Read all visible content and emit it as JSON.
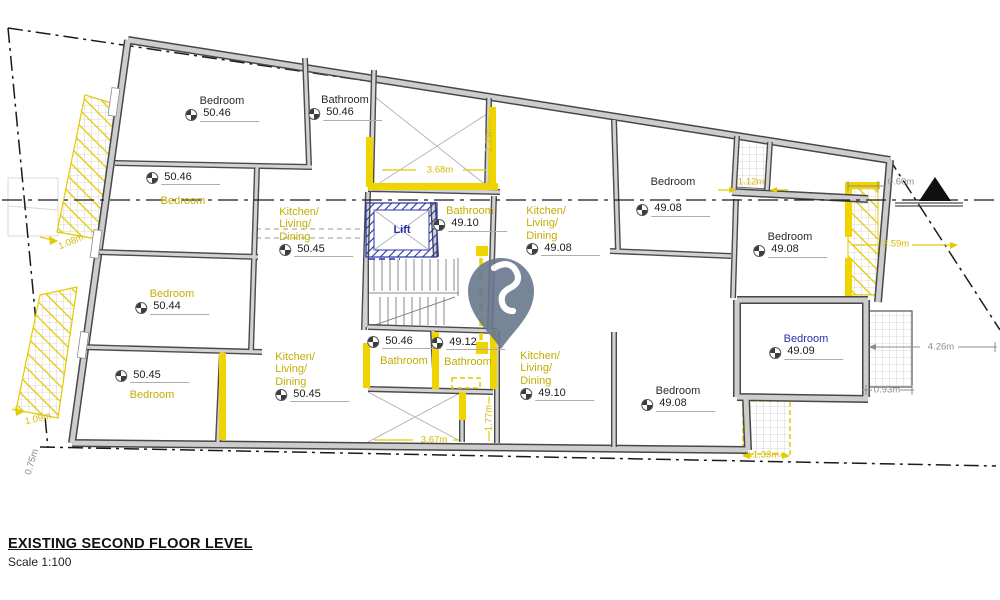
{
  "title": {
    "heading": "EXISTING SECOND FLOOR LEVEL",
    "scale": "Scale 1:100"
  },
  "colors": {
    "highlight": "#f0d400",
    "hatch_yellow": "#e4ca00",
    "label_yellow": "#c4ad00",
    "dim_yellow": "#d6b800",
    "blue": "#2733a8",
    "pin_gray_blue": "#68788c",
    "dim_gray": "#8c8c8c",
    "ink": "#1f1f1f"
  },
  "icons": {
    "pin": "location-pin",
    "north": "north-arrow",
    "spot_level": "quartered-circle-level-marker"
  },
  "rooms": [
    {
      "id": "bedroom-top-left",
      "lines": [
        "Bedroom"
      ],
      "color": "black",
      "value": "50.46",
      "order": "nf",
      "cx": 222,
      "y": 95
    },
    {
      "id": "bathroom-top-left",
      "lines": [
        "Bathroom"
      ],
      "color": "black",
      "value": "50.46",
      "order": "nf",
      "cx": 345,
      "y": 94
    },
    {
      "id": "bedroom-left-1",
      "lines": [
        "Bedroom"
      ],
      "color": "yellow",
      "value": "50.46",
      "order": "vf",
      "gap": 10,
      "cx": 183,
      "y": 171
    },
    {
      "id": "kitchen-living-dining-left-top",
      "lines": [
        "Kitchen/",
        "Living/",
        "Dining"
      ],
      "color": "yellow",
      "value": "50.45",
      "order": "nf",
      "cx": 316,
      "y": 206
    },
    {
      "id": "bedroom-left-2",
      "lines": [
        "Bedroom"
      ],
      "color": "yellow",
      "value": "50.44",
      "order": "nf",
      "cx": 172,
      "y": 288
    },
    {
      "id": "bedroom-left-3",
      "lines": [
        "Bedroom"
      ],
      "color": "yellow",
      "value": "50.45",
      "order": "vf",
      "gap": 6,
      "cx": 152,
      "y": 369
    },
    {
      "id": "kitchen-living-dining-left-bottom",
      "lines": [
        "Kitchen/",
        "Living/",
        "Dining"
      ],
      "color": "yellow",
      "value": "50.45",
      "order": "nf",
      "cx": 312,
      "y": 351
    },
    {
      "id": "lift",
      "lines": [
        "Lift"
      ],
      "color": "blue",
      "bold": true,
      "value": null,
      "order": "nf",
      "cx": 402,
      "y": 224
    },
    {
      "id": "bathroom-center",
      "lines": [
        "Bathroom"
      ],
      "color": "yellow",
      "value": "49.10",
      "order": "nf",
      "cx": 470,
      "y": 205
    },
    {
      "id": "kitchen-living-dining-center",
      "lines": [
        "Kitchen/",
        "Living/",
        "Dining"
      ],
      "color": "yellow",
      "value": "49.08",
      "order": "nf",
      "cx": 563,
      "y": 205
    },
    {
      "id": "bedroom-top-right",
      "lines": [
        "Bedroom"
      ],
      "color": "black",
      "value": "49.08",
      "order": "nf",
      "gap": 14,
      "cx": 673,
      "y": 176
    },
    {
      "id": "bedroom-right",
      "lines": [
        "Bedroom"
      ],
      "color": "black",
      "value": "49.08",
      "order": "nf",
      "cx": 790,
      "y": 231
    },
    {
      "id": "bathroom-bottom-1",
      "lines": [
        "Bathroom"
      ],
      "color": "yellow",
      "value": "50.46",
      "order": "vf",
      "gap": 6,
      "cx": 404,
      "y": 335
    },
    {
      "id": "bathroom-bottom-2",
      "lines": [
        "Bathroom"
      ],
      "color": "yellow",
      "value": "49.12",
      "order": "vf",
      "gap": 6,
      "cx": 468,
      "y": 336
    },
    {
      "id": "kitchen-living-dining-bottom",
      "lines": [
        "Kitchen/",
        "Living/",
        "Dining"
      ],
      "color": "yellow",
      "value": "49.10",
      "order": "nf",
      "cx": 557,
      "y": 350
    },
    {
      "id": "bedroom-bottom",
      "lines": [
        "Bedroom"
      ],
      "color": "black",
      "value": "49.08",
      "order": "nf",
      "cx": 678,
      "y": 385
    },
    {
      "id": "bedroom-bottom-right",
      "lines": [
        "Bedroom"
      ],
      "color": "blue",
      "value": "49.09",
      "order": "nf",
      "cx": 806,
      "y": 333
    }
  ],
  "dimensions": [
    {
      "text": "3.68m",
      "x": 440,
      "y": 170,
      "color": "y"
    },
    {
      "text": "2.25m",
      "x": 489,
      "y": 139,
      "color": "y",
      "rot": -90
    },
    {
      "text": "1.12m",
      "x": 751,
      "y": 182,
      "color": "y"
    },
    {
      "text": "0.60m",
      "x": 901,
      "y": 182,
      "color": "g"
    },
    {
      "text": "2.59m",
      "x": 896,
      "y": 244,
      "color": "y"
    },
    {
      "text": "4.26m",
      "x": 941,
      "y": 347,
      "color": "g"
    },
    {
      "text": "0.93m",
      "x": 887,
      "y": 390,
      "color": "g"
    },
    {
      "text": "1.33m",
      "x": 766,
      "y": 455,
      "color": "y"
    },
    {
      "text": "3.67m",
      "x": 434,
      "y": 440,
      "color": "y"
    },
    {
      "text": "1.77m",
      "x": 489,
      "y": 418,
      "color": "y",
      "rot": -90
    },
    {
      "text": "1.08m",
      "x": 71,
      "y": 242,
      "color": "y",
      "rot": -23
    },
    {
      "text": "1.09m",
      "x": 38,
      "y": 419,
      "color": "y",
      "rot": -13
    },
    {
      "text": "0.75m",
      "x": 32,
      "y": 462,
      "color": "g",
      "rot": -73
    }
  ]
}
